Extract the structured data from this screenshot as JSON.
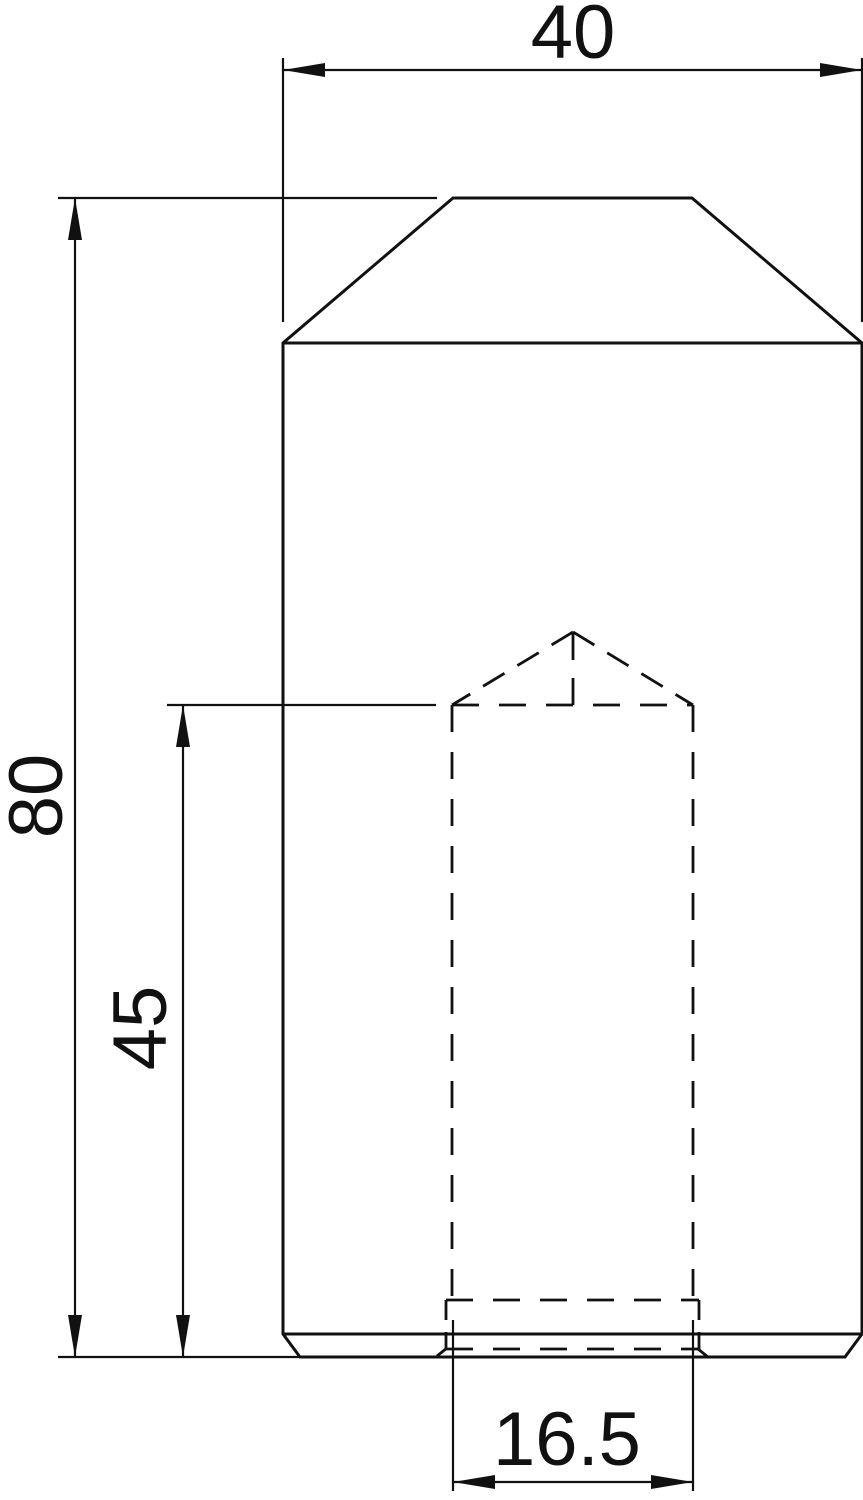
{
  "drawing": {
    "kind": "engineering-dimension-drawing",
    "line_color": "#111111",
    "background_color": "#ffffff",
    "dimensions": {
      "overall_width": {
        "label": "40"
      },
      "overall_height": {
        "label": "80"
      },
      "hole_depth": {
        "label": "45"
      },
      "hole_diameter": {
        "label": "16.5"
      }
    }
  }
}
